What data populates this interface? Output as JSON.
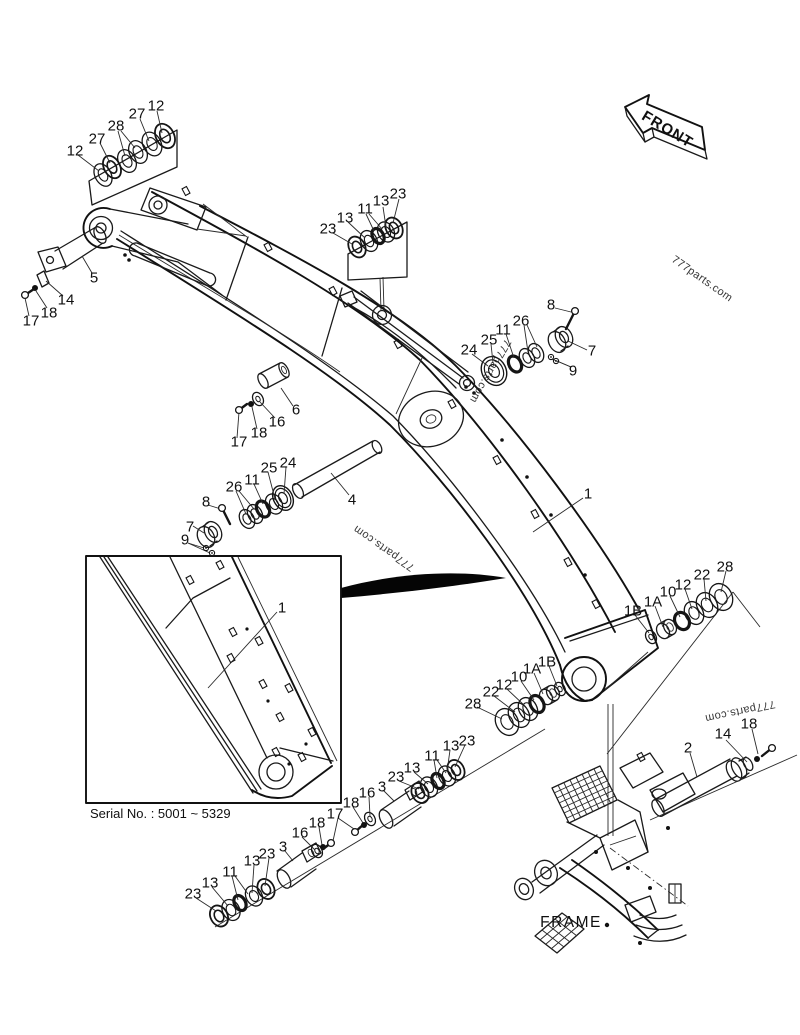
{
  "figure": {
    "front_arrow_label": "FRONT",
    "frame_label": "FRAME",
    "serial_note": "Serial No. : 5001 ~ 5329",
    "watermark_text": "777parts.com",
    "callouts": [
      {
        "t": "12",
        "x": 75,
        "y": 151
      },
      {
        "t": "27",
        "x": 97,
        "y": 139
      },
      {
        "t": "28",
        "x": 116,
        "y": 126
      },
      {
        "t": "27",
        "x": 137,
        "y": 114
      },
      {
        "t": "12",
        "x": 156,
        "y": 106
      },
      {
        "t": "23",
        "x": 328,
        "y": 229
      },
      {
        "t": "13",
        "x": 345,
        "y": 218
      },
      {
        "t": "11",
        "x": 365,
        "y": 209
      },
      {
        "t": "13",
        "x": 381,
        "y": 201
      },
      {
        "t": "23",
        "x": 398,
        "y": 194
      },
      {
        "t": "5",
        "x": 94,
        "y": 278
      },
      {
        "t": "14",
        "x": 66,
        "y": 300
      },
      {
        "t": "18",
        "x": 49,
        "y": 313
      },
      {
        "t": "17",
        "x": 31,
        "y": 321
      },
      {
        "t": "6",
        "x": 296,
        "y": 410
      },
      {
        "t": "16",
        "x": 277,
        "y": 422
      },
      {
        "t": "18",
        "x": 259,
        "y": 433
      },
      {
        "t": "17",
        "x": 239,
        "y": 442
      },
      {
        "t": "8",
        "x": 551,
        "y": 305
      },
      {
        "t": "26",
        "x": 521,
        "y": 321
      },
      {
        "t": "11",
        "x": 503,
        "y": 330
      },
      {
        "t": "25",
        "x": 489,
        "y": 340
      },
      {
        "t": "24",
        "x": 469,
        "y": 350
      },
      {
        "t": "7",
        "x": 592,
        "y": 351
      },
      {
        "t": "9",
        "x": 573,
        "y": 371
      },
      {
        "t": "24",
        "x": 288,
        "y": 463
      },
      {
        "t": "25",
        "x": 269,
        "y": 468
      },
      {
        "t": "11",
        "x": 252,
        "y": 480
      },
      {
        "t": "26",
        "x": 234,
        "y": 487
      },
      {
        "t": "8",
        "x": 206,
        "y": 502
      },
      {
        "t": "7",
        "x": 190,
        "y": 527
      },
      {
        "t": "9",
        "x": 185,
        "y": 540
      },
      {
        "t": "4",
        "x": 352,
        "y": 500
      },
      {
        "t": "1",
        "x": 588,
        "y": 494
      },
      {
        "t": "1",
        "x": 282,
        "y": 608
      },
      {
        "t": "1B",
        "x": 633,
        "y": 611
      },
      {
        "t": "1A",
        "x": 653,
        "y": 602
      },
      {
        "t": "10",
        "x": 668,
        "y": 592
      },
      {
        "t": "12",
        "x": 683,
        "y": 585
      },
      {
        "t": "22",
        "x": 702,
        "y": 575
      },
      {
        "t": "28",
        "x": 725,
        "y": 567
      },
      {
        "t": "28",
        "x": 473,
        "y": 704
      },
      {
        "t": "22",
        "x": 491,
        "y": 692
      },
      {
        "t": "12",
        "x": 504,
        "y": 685
      },
      {
        "t": "10",
        "x": 519,
        "y": 677
      },
      {
        "t": "1A",
        "x": 532,
        "y": 669
      },
      {
        "t": "1B",
        "x": 547,
        "y": 662
      },
      {
        "t": "23",
        "x": 467,
        "y": 741
      },
      {
        "t": "13",
        "x": 451,
        "y": 746
      },
      {
        "t": "11",
        "x": 432,
        "y": 756
      },
      {
        "t": "13",
        "x": 412,
        "y": 768
      },
      {
        "t": "23",
        "x": 396,
        "y": 777
      },
      {
        "t": "3",
        "x": 382,
        "y": 787
      },
      {
        "t": "16",
        "x": 367,
        "y": 793
      },
      {
        "t": "18",
        "x": 351,
        "y": 803
      },
      {
        "t": "17",
        "x": 335,
        "y": 814
      },
      {
        "t": "18",
        "x": 317,
        "y": 823
      },
      {
        "t": "16",
        "x": 300,
        "y": 833
      },
      {
        "t": "3",
        "x": 283,
        "y": 847
      },
      {
        "t": "23",
        "x": 267,
        "y": 854
      },
      {
        "t": "13",
        "x": 252,
        "y": 861
      },
      {
        "t": "11",
        "x": 230,
        "y": 872
      },
      {
        "t": "13",
        "x": 210,
        "y": 883
      },
      {
        "t": "23",
        "x": 193,
        "y": 894
      },
      {
        "t": "2",
        "x": 688,
        "y": 748
      },
      {
        "t": "14",
        "x": 723,
        "y": 734
      },
      {
        "t": "18",
        "x": 749,
        "y": 724
      }
    ]
  }
}
